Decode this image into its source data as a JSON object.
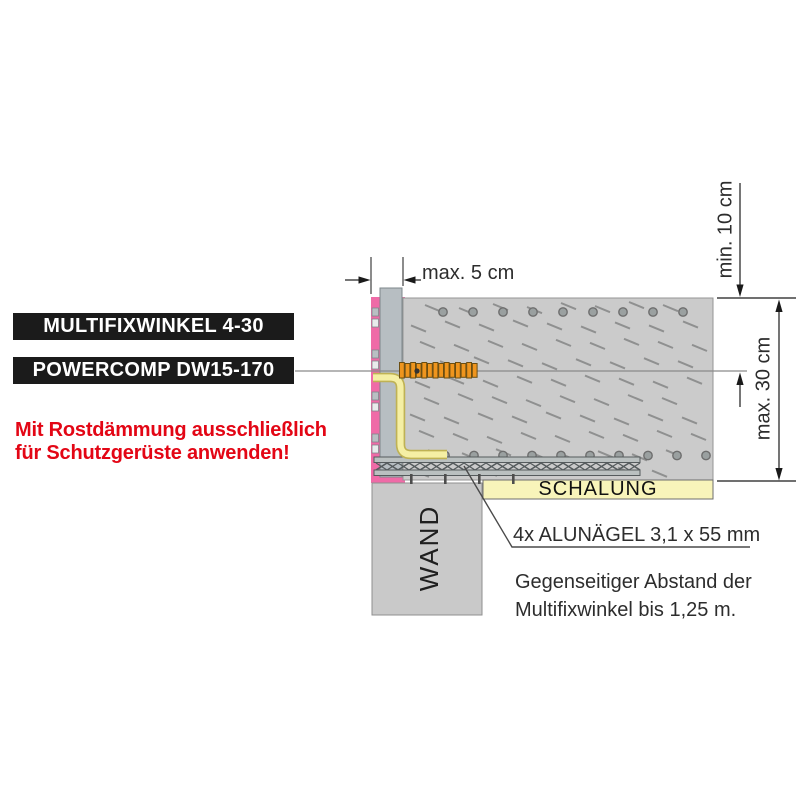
{
  "product_labels": {
    "box1": "MULTIFIXWINKEL 4-30",
    "box2": "POWERCOMP DW15-170"
  },
  "warning": {
    "line1": "Mit Rostdämmung ausschließlich",
    "line2": "für Schutzgerüste anwenden!"
  },
  "dimensions": {
    "gap": "max. 5 cm",
    "top_clearance": "min. 10 cm",
    "slab_height": "max. 30 cm"
  },
  "diagram_labels": {
    "formwork": "SCHALUNG",
    "wall": "WAND"
  },
  "annotations": {
    "nails": "4x ALUNÄGEL 3,1 x 55 mm",
    "spacing_line1": "Gegenseitiger Abstand der",
    "spacing_line2": "Multifixwinkel bis 1,25 m."
  },
  "colors": {
    "background": "#ffffff",
    "label_box_bg": "#1b1b1b",
    "label_box_text": "#ffffff",
    "warning_red": "#e30615",
    "concrete": "#cbcbcb",
    "concrete_hatch": "#8f9090",
    "insulation_pink": "#ef6ba7",
    "anchor_orange": "#ef951e",
    "bracket_yellow": "#f5efa4",
    "bracket_yellow_edge": "#bfb254",
    "formwork_yellow": "#f8f4ba",
    "steel_gray": "#b7bec2",
    "truss_gray": "#bac0c0",
    "wall_gray": "#c9c9c9",
    "line_dark": "#1a1a1a",
    "leader_gray": "#8a8a8a",
    "text_dark": "#2d2d2d"
  }
}
